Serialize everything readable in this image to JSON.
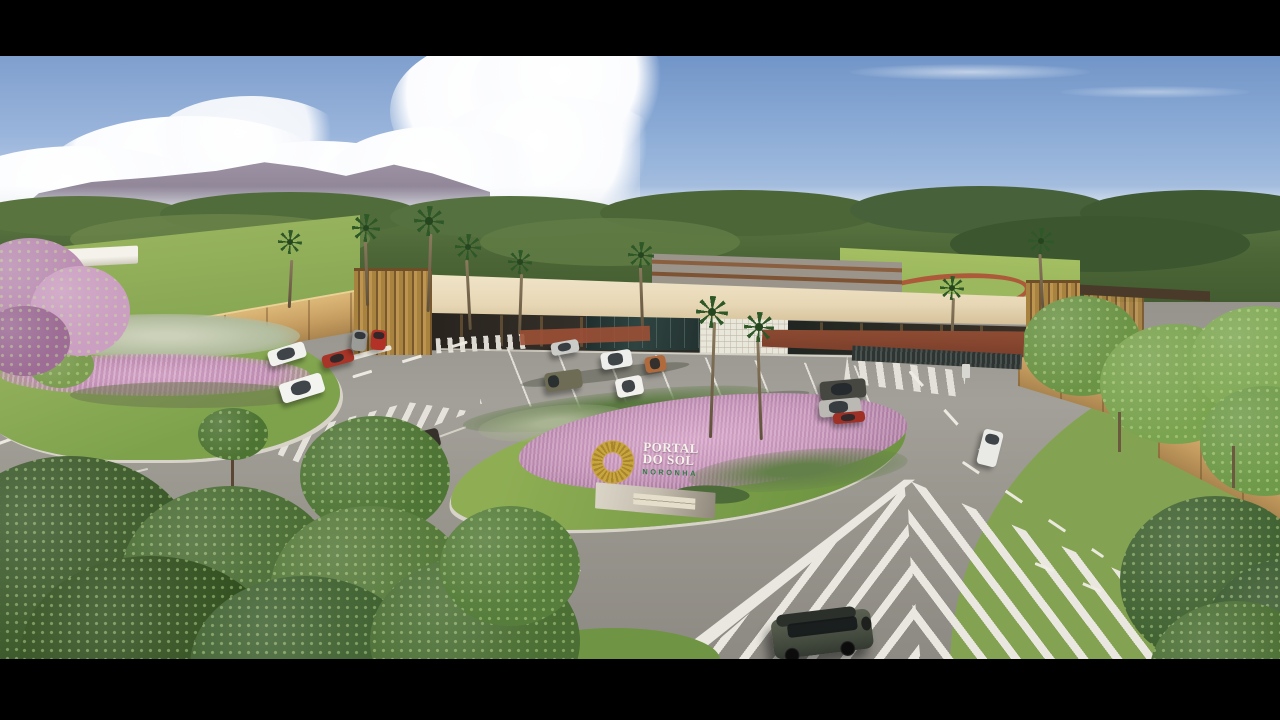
{
  "scene": {
    "title": "Aerial 3D render of gated community entrance",
    "sign": {
      "logo_icon": "sun-wreath-logo",
      "line1": "PORTAL",
      "line2": "DO SOL",
      "line3": "NORONHA"
    },
    "palette": {
      "letterbox": "#000000",
      "sky_top": "#7f9fcd",
      "sky_horizon": "#d8e2ee",
      "cloud": "#ffffff",
      "mountain": "#8f8496",
      "forest": "#446033",
      "lawn": "#86a851",
      "pink_grass": "#c495b8",
      "asphalt": "#9a978f",
      "road_marking": "#ece9e0",
      "canopy_cream": "#e8d9b8",
      "wood_slat": "#a8823f",
      "perimeter_wall": "#c8a164",
      "track_red": "#ad5a3a",
      "sign_gold": "#c9a53e",
      "sign_green": "#2e7d46",
      "sign_stone": "#c9c2b2"
    },
    "vehicles": [
      "white suv",
      "red hatchback",
      "gray parked car",
      "red parked car",
      "white sedan",
      "dark sedan",
      "silver sedan",
      "olive pickup",
      "white sedan",
      "white sedan",
      "bronze compact",
      "dark parked suv",
      "silver parked car",
      "red parked car",
      "white pickup",
      "dark green offroad suv"
    ]
  }
}
